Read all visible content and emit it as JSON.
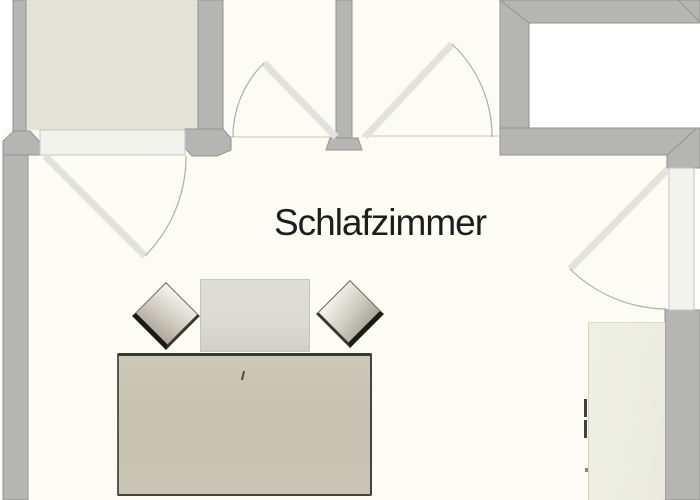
{
  "room": {
    "label": "Schlafzimmer"
  },
  "colors": {
    "wall": "#b5b5b4",
    "wall-edge": "#929290",
    "floor-beige": "#e3e3d7",
    "floor-white": "#fcfbf4",
    "floor-pure": "#ffffff",
    "threshold": "#f3f3ee",
    "threshold-edge": "#c6c6c1",
    "door-leaf": "#e3e2dd",
    "arc": "#aeaeab",
    "bed": "#c8c4b4",
    "bed-edge": "#38362e",
    "cushion": "#dcdad4",
    "pillow-light": "#f2f1eb",
    "pillow-dark": "#a9a699",
    "pillow-edge": "#1b1a16",
    "wardrobe": "#edeee2",
    "handle": "#41403a",
    "text": "#1d1d1b"
  }
}
